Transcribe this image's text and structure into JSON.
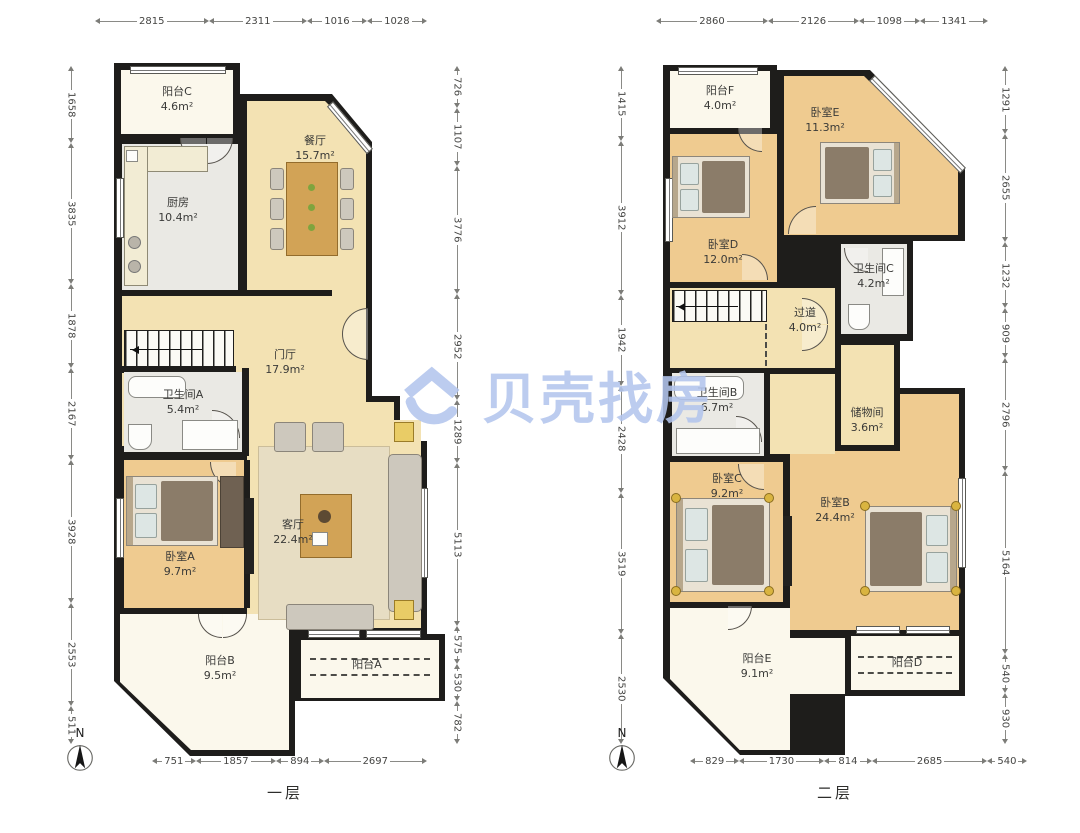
{
  "watermark": {
    "brand": "贝壳找房",
    "logo": "beike-house-logo",
    "color": "#b3c5ed"
  },
  "compass": {
    "north_label": "N"
  },
  "floor1": {
    "caption": "一层",
    "rooms": {
      "balcony_c": {
        "name": "阳台C",
        "area": "4.6m²"
      },
      "dining": {
        "name": "餐厅",
        "area": "15.7m²"
      },
      "kitchen": {
        "name": "厨房",
        "area": "10.4m²"
      },
      "foyer": {
        "name": "门厅",
        "area": "17.9m²"
      },
      "bath_a": {
        "name": "卫生间A",
        "area": "5.4m²"
      },
      "bedroom_a": {
        "name": "卧室A",
        "area": "9.7m²"
      },
      "living": {
        "name": "客厅",
        "area": "22.4m²"
      },
      "balcony_b": {
        "name": "阳台B",
        "area": "9.5m²"
      },
      "balcony_a": {
        "name": "阳台A",
        "area": ""
      }
    },
    "dims": {
      "top": [
        "2815",
        "2311",
        "1016",
        "1028"
      ],
      "left": [
        "1658",
        "3835",
        "1878",
        "2167",
        "3928",
        "2553",
        "511"
      ],
      "right": [
        "726",
        "1107",
        "3776",
        "2952",
        "1289",
        "5113",
        "575",
        "530",
        "782"
      ],
      "bottom": [
        "751",
        "1857",
        "894",
        "2697"
      ]
    }
  },
  "floor2": {
    "caption": "二层",
    "rooms": {
      "balcony_f": {
        "name": "阳台F",
        "area": "4.0m²"
      },
      "bedroom_e": {
        "name": "卧室E",
        "area": "11.3m²"
      },
      "bedroom_d": {
        "name": "卧室D",
        "area": "12.0m²"
      },
      "bath_c": {
        "name": "卫生间C",
        "area": "4.2m²"
      },
      "hallway": {
        "name": "过道",
        "area": "4.0m²"
      },
      "bath_b": {
        "name": "卫生间B",
        "area": "6.7m²"
      },
      "storage": {
        "name": "储物间",
        "area": "3.6m²"
      },
      "bedroom_c": {
        "name": "卧室C",
        "area": "9.2m²"
      },
      "bedroom_b": {
        "name": "卧室B",
        "area": "24.4m²"
      },
      "balcony_e": {
        "name": "阳台E",
        "area": "9.1m²"
      },
      "balcony_d": {
        "name": "阳台D",
        "area": ""
      }
    },
    "dims": {
      "top": [
        "2860",
        "2126",
        "1098",
        "1341"
      ],
      "left": [
        "1415",
        "3912",
        "1942",
        "2428",
        "3519",
        "2530"
      ],
      "right": [
        "1291",
        "2655",
        "1232",
        "909",
        "2796",
        "5164",
        "540",
        "930"
      ],
      "bottom": [
        "829",
        "1730",
        "814",
        "2685",
        "540"
      ]
    }
  }
}
